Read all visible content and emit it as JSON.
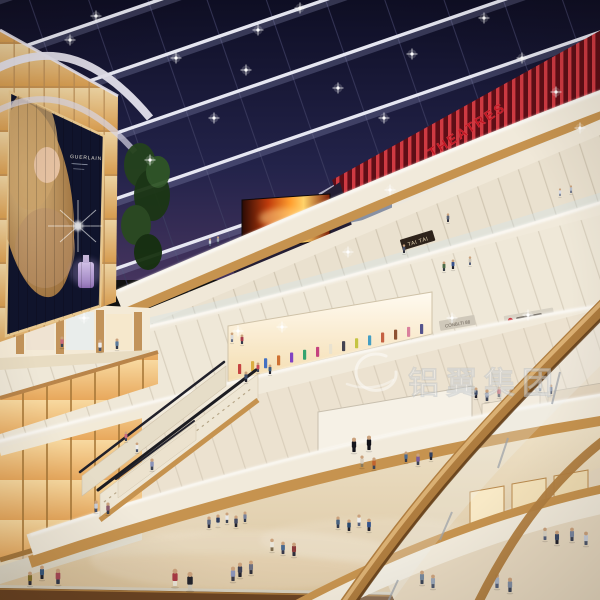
{
  "meta": {
    "title": "Shopping mall atrium interior rendering at dusk",
    "levels_visible": 5
  },
  "signage": {
    "theatre_sign": "THEATRES",
    "shop_sign_tai_tai": "TAI TAI",
    "shop_sign_2": "CONBLTI 88",
    "billboard_brand": "GUERLAIN",
    "watermark_text": "铝翼集团"
  },
  "palette": {
    "sky": "#1a1a38",
    "beam_white": "#edeef8",
    "theatre_red": "#c01824",
    "cream_band": "#f1eadb",
    "wood": "#c6934f",
    "amber_panel": "#f2c98a",
    "floor": "#e7dabc",
    "watermark_white": "#ffffff"
  },
  "scene": {
    "lights": [
      [
        96,
        16
      ],
      [
        176,
        58
      ],
      [
        258,
        30
      ],
      [
        300,
        8
      ],
      [
        338,
        88
      ],
      [
        412,
        54
      ],
      [
        484,
        18
      ],
      [
        522,
        58
      ],
      [
        556,
        92
      ],
      [
        214,
        118
      ],
      [
        150,
        160
      ],
      [
        384,
        118
      ],
      [
        580,
        128
      ],
      [
        246,
        70
      ],
      [
        70,
        40
      ],
      [
        452,
        318
      ],
      [
        528,
        315
      ],
      [
        282,
        327
      ],
      [
        238,
        331
      ],
      [
        390,
        190
      ],
      [
        348,
        252
      ],
      [
        84,
        318
      ]
    ],
    "reddots": {
      "x0": 357,
      "y0": 260,
      "x1": 612,
      "y1": 141,
      "count": 20
    },
    "racks": {
      "x0": 238,
      "dx": 13,
      "count": 15,
      "y0": 374,
      "slope": -0.22,
      "h": 10,
      "colors": [
        "#c23a3a",
        "#d8aa3a",
        "#3a6ac2",
        "#cc6a2a",
        "#7a3ac2",
        "#2aa06a",
        "#c23a7a",
        "#e8e2d0",
        "#3a3a4a",
        "#c2c23a",
        "#3a9ac2",
        "#c25a3a",
        "#884a2a",
        "#d87a9a",
        "#4a4a88"
      ]
    },
    "people": [
      [
        175,
        586,
        18,
        "#a83a44",
        "#e8e2d4"
      ],
      [
        190,
        590,
        19,
        "#23242c",
        "#cfc7b5"
      ],
      [
        240,
        577,
        15,
        "#3c3f52",
        "#23232d"
      ],
      [
        251,
        574,
        14,
        "#6b6e80",
        "#2e2e38"
      ],
      [
        233,
        581,
        15,
        "#8a93b8",
        "#3a3a46"
      ],
      [
        272,
        551,
        13,
        "#e9e5da",
        "#7b6a4e"
      ],
      [
        283,
        554,
        13,
        "#49698f",
        "#39394a"
      ],
      [
        294,
        556,
        14,
        "#8a3a3a",
        "#2e2e3c"
      ],
      [
        218,
        526,
        12,
        "#2e3c5e",
        "#d9d2c2"
      ],
      [
        227,
        523,
        11,
        "#e8e8e8",
        "#3a4254"
      ],
      [
        236,
        527,
        12,
        "#454b63",
        "#23232d"
      ],
      [
        245,
        522,
        11,
        "#76809a",
        "#323a4e"
      ],
      [
        209,
        528,
        12,
        "#5f6a84",
        "#2c2c38"
      ],
      [
        338,
        528,
        12,
        "#47617f",
        "#333a4c"
      ],
      [
        349,
        531,
        12,
        "#2c4a6e",
        "#22222c"
      ],
      [
        359,
        526,
        12,
        "#ececec",
        "#56607a"
      ],
      [
        369,
        531,
        13,
        "#35548c",
        "#23232e"
      ],
      [
        422,
        584,
        14,
        "#76889c",
        "#3c4456"
      ],
      [
        433,
        588,
        14,
        "#9aa6b6",
        "#4e586c"
      ],
      [
        58,
        584,
        16,
        "#a84a58",
        "#333a4c"
      ],
      [
        42,
        579,
        14,
        "#3c5a7c",
        "#22222c"
      ],
      [
        30,
        585,
        14,
        "#86742f",
        "#2e2e38"
      ],
      [
        545,
        540,
        13,
        "#d8d2c4",
        "#55607a"
      ],
      [
        557,
        544,
        14,
        "#3b4a66",
        "#23232d"
      ],
      [
        572,
        541,
        14,
        "#7a87a0",
        "#3c4254"
      ],
      [
        586,
        545,
        14,
        "#c7cdd8",
        "#4e586c"
      ],
      [
        497,
        588,
        15,
        "#aab4c4",
        "#55607a"
      ],
      [
        510,
        592,
        15,
        "#808da2",
        "#3c4456"
      ],
      [
        362,
        467,
        12,
        "#d9cfc0",
        "#8a7a5c"
      ],
      [
        374,
        469,
        12,
        "#c2632e",
        "#3c4456"
      ],
      [
        406,
        462,
        11,
        "#49698f",
        "#333a4c"
      ],
      [
        418,
        465,
        12,
        "#7a5c9c",
        "#3c4254"
      ],
      [
        431,
        460,
        11,
        "#33415f",
        "#22222c"
      ],
      [
        354,
        452,
        15,
        "#16161e",
        "#16161e"
      ],
      [
        369,
        450,
        15,
        "#111119",
        "#111119"
      ],
      [
        476,
        398,
        11,
        "#3c4a66",
        "#23232d"
      ],
      [
        487,
        401,
        12,
        "#8a93a8",
        "#3c4456"
      ],
      [
        499,
        397,
        11,
        "#c74a55",
        "#2e2e38"
      ],
      [
        511,
        401,
        12,
        "#49698f",
        "#333a4c"
      ],
      [
        540,
        391,
        10,
        "#d9d2c4",
        "#55607a"
      ],
      [
        551,
        394,
        10,
        "#76809a",
        "#3c4254"
      ],
      [
        62,
        347,
        11,
        "#c86a7c",
        "#3c4456"
      ],
      [
        100,
        351,
        12,
        "#ececec",
        "#49526a"
      ],
      [
        117,
        349,
        11,
        "#5a7a9c",
        "#333a4c"
      ],
      [
        232,
        342,
        10,
        "#d9d9d9",
        "#666e84"
      ],
      [
        242,
        344,
        10,
        "#a83a4a",
        "#333a4c"
      ],
      [
        210,
        246,
        8,
        "#c9ced8",
        "#55607a"
      ],
      [
        218,
        244,
        8,
        "#9aa2b4",
        "#3c4456"
      ],
      [
        444,
        271,
        10,
        "#4a6a46",
        "#333a44"
      ],
      [
        453,
        269,
        10,
        "#36518c",
        "#22222c"
      ],
      [
        470,
        265,
        9,
        "#c9c2b4",
        "#55607a"
      ],
      [
        560,
        196,
        8,
        "#d9dde6",
        "#7b8498"
      ],
      [
        571,
        193,
        8,
        "#b8c0cc",
        "#666e84"
      ],
      [
        258,
        372,
        10,
        "#c74a55",
        "#3c4456"
      ],
      [
        270,
        374,
        10,
        "#3c5a7c",
        "#23232d"
      ],
      [
        404,
        253,
        9,
        "#49526a",
        "#2c2c36"
      ],
      [
        448,
        222,
        9,
        "#5a6478",
        "#2e2e3a"
      ],
      [
        152,
        470,
        12,
        "#8a93b8",
        "#3c4456"
      ],
      [
        246,
        382,
        11,
        "#3c4a66",
        "#23232d"
      ],
      [
        126,
        441,
        10,
        "#c86a7c",
        "#3c4456"
      ],
      [
        137,
        452,
        10,
        "#ececec",
        "#49526a"
      ],
      [
        96,
        512,
        12,
        "#c9ced8",
        "#49526a"
      ],
      [
        108,
        514,
        12,
        "#8a5a6a",
        "#333a4c"
      ]
    ]
  }
}
